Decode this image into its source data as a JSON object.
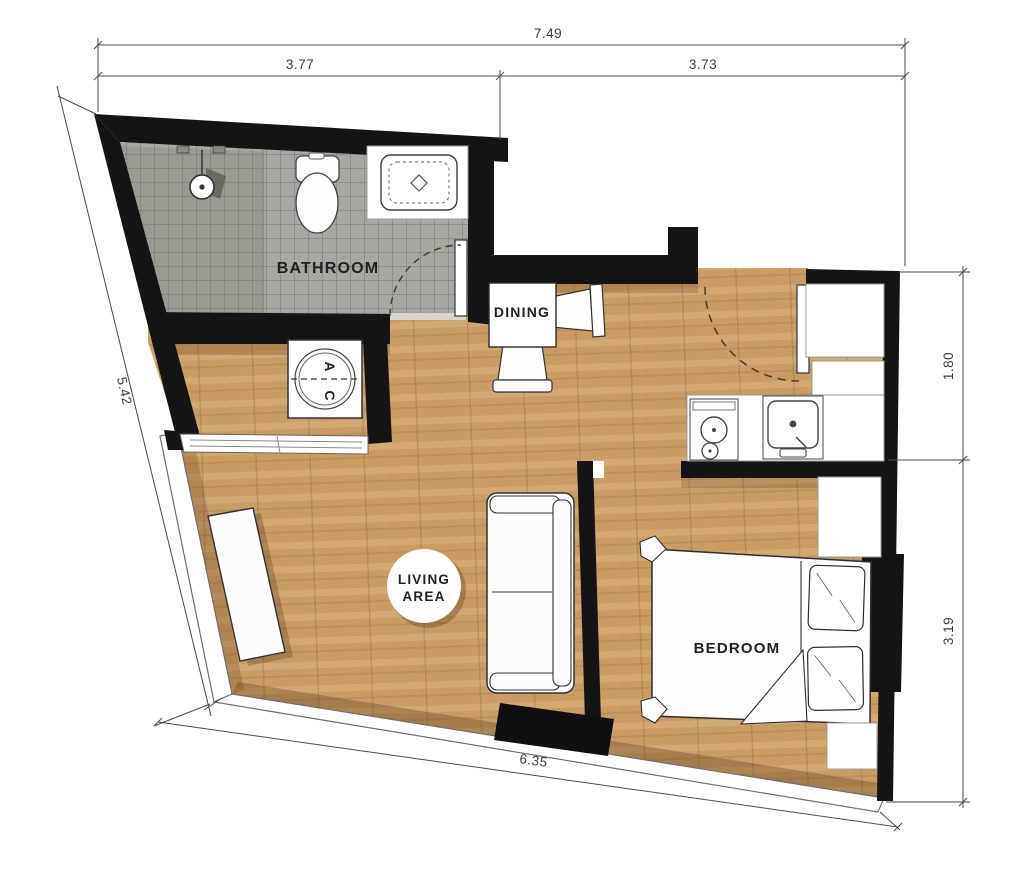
{
  "title": "apartment-floor-plan",
  "rooms": {
    "bathroom": "BATHROOM",
    "dining": "DINING",
    "living_line1": "LIVING",
    "living_line2": "AREA",
    "bedroom": "BEDROOM",
    "ac_letter_a": "A",
    "ac_letter_c": "C"
  },
  "dimensions": {
    "top_total": "7.49",
    "top_left": "3.77",
    "top_right": "3.73",
    "left": "5.42",
    "right_upper": "1.80",
    "right_lower": "3.19",
    "bottom": "6.35"
  },
  "fixtures": [
    "shower-head",
    "shower-divider",
    "toilet",
    "vanity-sink",
    "bathroom-door",
    "ac-unit",
    "ac-louver-doors",
    "dining-table",
    "dining-chair",
    "entry-door",
    "wardrobe",
    "kitchen-counter",
    "stove",
    "kitchen-sink",
    "sofa",
    "sideboard",
    "tv-console",
    "bed",
    "pillow",
    "nightstand",
    "window-wall"
  ],
  "colors": {
    "wall": "#141414",
    "wood": "#c89c63",
    "tile": "#a7a8a2",
    "dimension_line": "#4a4a4a",
    "label": "#222222",
    "furniture_outline": "#333333"
  }
}
